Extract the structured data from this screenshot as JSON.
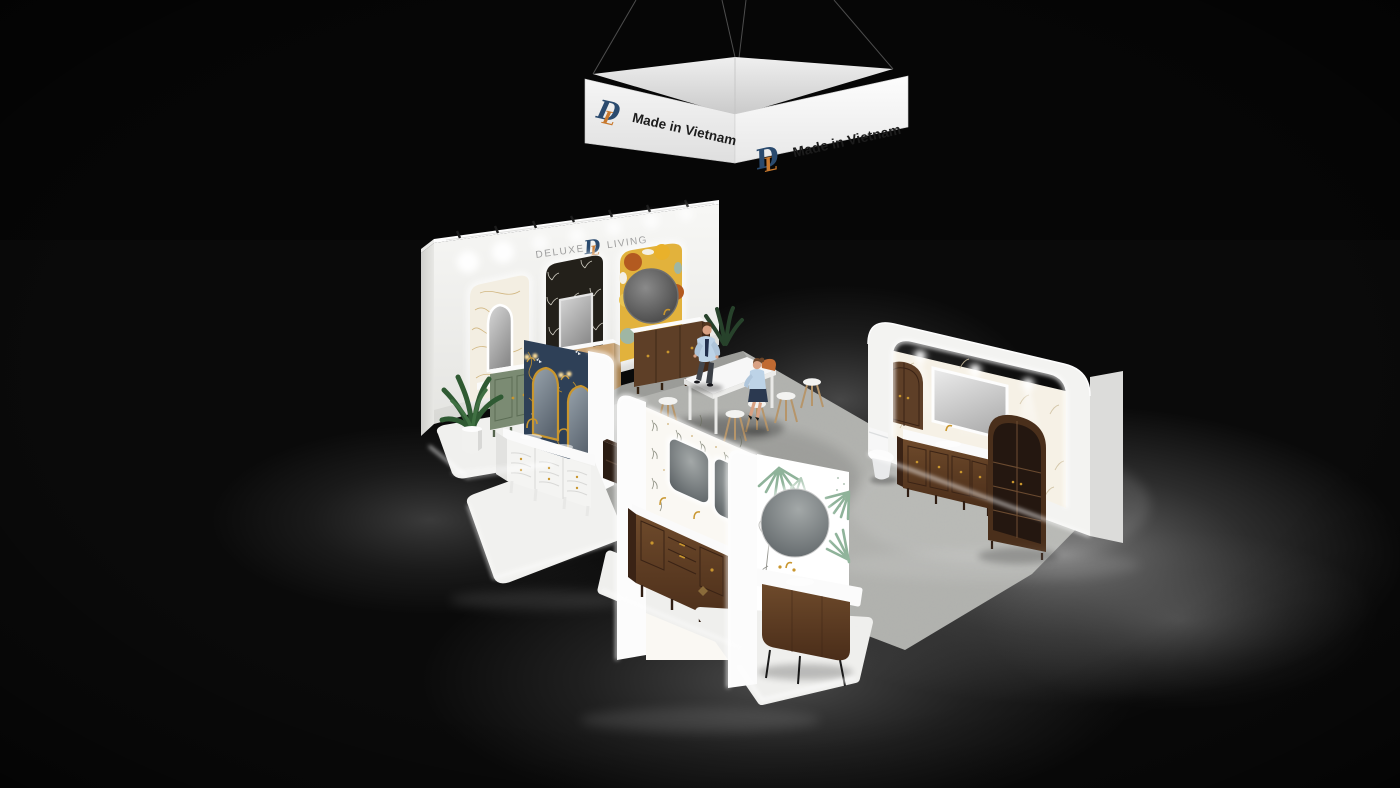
{
  "scene": {
    "type": "3d-render",
    "subject": "Deluxe Living bathroom-vanity exhibition booth with hanging banner",
    "banner": {
      "text": "Made in Vietnam",
      "logo_d": "D",
      "logo_l": "L"
    },
    "wall_brand": {
      "left": "DELUXE",
      "right": "LIVING",
      "logo_d": "D",
      "logo_l": "L"
    },
    "colors": {
      "room_bg": "#0a0a0a",
      "floor_pool": "#858585",
      "carpet": "#b2b3af",
      "booth_white": "#f4f4f2",
      "navy_panel": "#2e4057",
      "green_vanity": "#7b8b73",
      "oak": "#c8a171",
      "walnut": "#5e3f27",
      "walnut_dark": "#3f2817",
      "gold": "#c9962e",
      "logo_blue": "#2a4a6e",
      "logo_orange": "#c8792e",
      "brand_gray": "#9d9d9d",
      "banner_text": "#1c1c1c",
      "wallpaper_black": "#23201a",
      "wallpaper_yellow": "#e2b23c",
      "leaf_green": "#8fb39a",
      "skin": "#d9a183",
      "shirt_blue": "#bdd3e7",
      "bag_orange": "#c06a32"
    }
  }
}
